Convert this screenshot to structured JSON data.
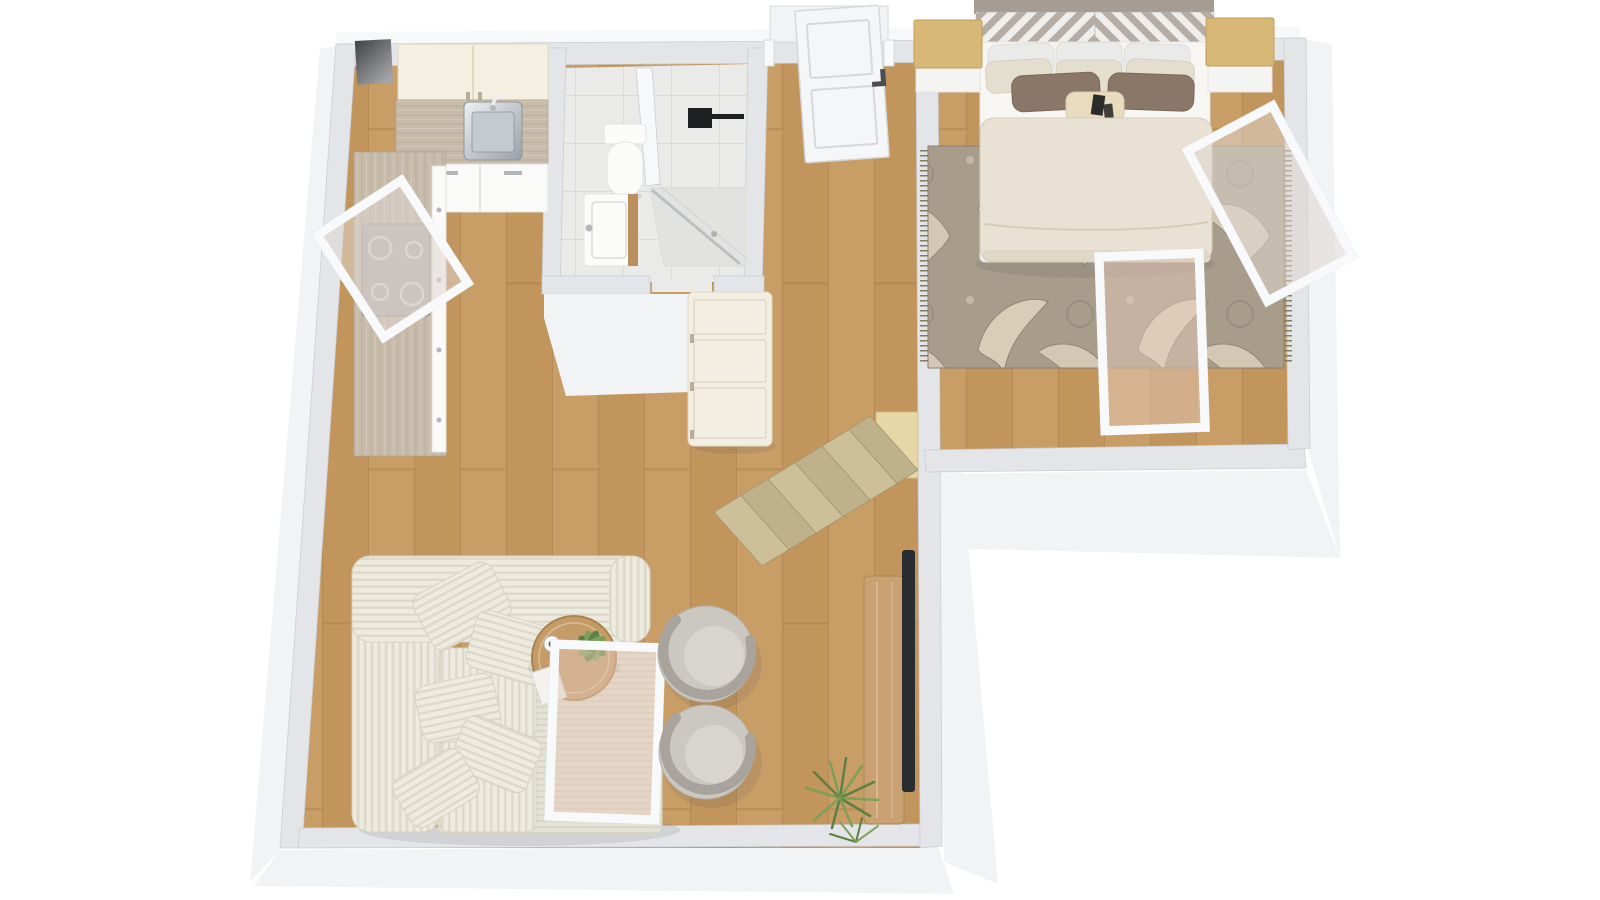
{
  "meta": {
    "view": "3d-floor-plan-top-down",
    "canvas_width": 1600,
    "canvas_height": 900
  },
  "palette": {
    "bg": "#ffffff",
    "wall_top": "#e3e5e8",
    "wall_face": "#f2f3f5",
    "wall_face_light": "#f7f8fa",
    "wall_line": "#c9ccd1",
    "oak_a": "#c99e66",
    "oak_b": "#c2955c",
    "oak_gap": "#aa7f4b",
    "tile": "#eaeae9",
    "tile_line": "#dbdbd9",
    "counter": "#c7bbaa",
    "counter_line": "#b2a590",
    "counter_hi": "#ffffff",
    "cabinet_cream": "#f3efe1",
    "cabinet_cream_line": "#e0dac4",
    "cabinet_white": "#fafaf8",
    "cabinet_white_line": "#e3e3e0",
    "handle": "#b4b7ba",
    "steel_light": "#eef0f2",
    "steel_dark": "#99a0a7",
    "steel_line": "#8d949b",
    "basin": "#c4cacf",
    "stove": "#b5b1ac",
    "stove_frame": "#97938e",
    "stove_ring": "#dad7d2",
    "shaft_dark": "#404143",
    "shaft_light": "#a3a4a6",
    "fixture_black": "#1f2022",
    "porcelain": "#fbfbfa",
    "porcelain_line": "#e3e3e0",
    "vanity_wood": "#ba8f5e",
    "shower_tray": "#e2e2e1",
    "shower_glass": "rgba(150,156,162,0.5)",
    "door": "#f5f6f8",
    "door_line": "#d6d9dc",
    "door_handle": "#4b4d4f",
    "wardrobe": "#f2eee1",
    "wardrobe_line": "#ded8c6",
    "wardrobe_handle": "#b4ad99",
    "stair_a": "#cdc099",
    "stair_b": "#bfb28a",
    "stair_edge": "#a3966f",
    "landing": "#e7d7a6",
    "landing_line": "#cfbf8e",
    "sofa": "#edebe0",
    "sofa_stripe": "#dbd8c8",
    "sofa_line": "#d5d2c3",
    "chaise": "#e4e2d4",
    "chaise_stripe": "#d7d5c5",
    "chair": "#cbc7c1",
    "chair_inner": "#d8d5d0",
    "chair_crescent": "#a8a49d",
    "chair_line": "#b7b3ac",
    "table_wood": "#c59b67",
    "table_edge": "#a9844e",
    "book": "#f3f2ef",
    "cup": "#fcfcfb",
    "coffee": "#6f604f",
    "plant": "#7f9f58",
    "plant_dark": "#5d8044",
    "sideboard": "#c9a172",
    "sideboard_edge": "#ae8754",
    "tv": "#2a2d30",
    "rug_base": "#a89d8a",
    "rug_motif": "#ded4bd",
    "rug_line": "#8a8172",
    "rug_fringe": "#857c5e",
    "bed_white": "#f7f6f3",
    "bed_line": "#e5e2dc",
    "duvet": "#e9e2d4",
    "duvet_line": "#d6cdb9",
    "pillow_white": "#eaebe9",
    "pillow_white_line": "#dcdedc",
    "pillow_cream": "#e4decf",
    "pillow_cream_line": "#d6d0bf",
    "pillow_brown": "#8a7767",
    "pillow_brown_line": "#796856",
    "pillow_pattern": "#e9dcbe",
    "pillow_pattern_line": "#d6c9a9",
    "pillow_black": "#2c2c2a",
    "headboard_rail": "#a59d93",
    "chevron_gray": "#b3ada5",
    "chevron_white": "#efeeeb",
    "nightstand": "#d8b876",
    "nightstand_edge": "#c19e5c",
    "nightstand_base": "#f4f4f2",
    "window_frame": "#f8f9fa",
    "window_frame_line": "#d8dce0",
    "glass_cool": "rgba(222,213,207,0.55)",
    "glass_warm": "rgba(228,200,183,0.5)",
    "shadow": "rgba(70,72,85,0.12)"
  },
  "rooms": [
    {
      "id": "kitchen",
      "furniture": [
        "upper-cabinets",
        "countertop",
        "kitchen-sink",
        "faucet",
        "base-cabinets",
        "cooktop",
        "tilted-open-window"
      ]
    },
    {
      "id": "bathroom",
      "furniture": [
        "toilet",
        "vanity-sink",
        "corner-shower",
        "shower-glass",
        "black-shower-fixture"
      ]
    },
    {
      "id": "hallway",
      "furniture": [
        "entry-door",
        "wardrobe-cabinet"
      ]
    },
    {
      "id": "living-room",
      "furniture": [
        "corner-sofa",
        "throw-pillows",
        "round-coffee-table",
        "table-plant",
        "coffee-cup",
        "book",
        "swivel-armchair",
        "swivel-armchair",
        "tilted-open-window",
        "media-sideboard",
        "wall-tv",
        "floor-plant",
        "staircase",
        "stair-landing"
      ]
    },
    {
      "id": "bedroom",
      "furniture": [
        "double-bed",
        "chevron-headboard",
        "bed-pillows",
        "accent-pillows",
        "lumbar-pillow",
        "duvet",
        "nightstand-left",
        "nightstand-right",
        "damask-area-rug",
        "tilted-open-window-right",
        "tilted-open-window-foot"
      ]
    }
  ]
}
